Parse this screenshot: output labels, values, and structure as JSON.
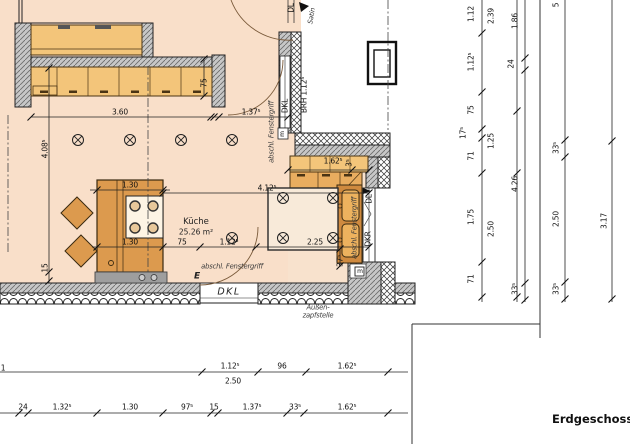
{
  "title": {
    "plan_label": "Erdgeschoss"
  },
  "room": {
    "name": "Küche",
    "area": "25.26 m²"
  },
  "colors": {
    "room": "#f9dfc9",
    "nook": "#f8e2cd",
    "cab": "#f3c57a",
    "mid": "#e9ad5f",
    "island": "#dc9a4e",
    "sinkc": "#cf8a3f",
    "basin": "#edb25e",
    "table": "#f8ead9",
    "wall": "#c7c7c7",
    "plinth": "#9e9e9e",
    "edge": "#3a2a10",
    "dim": "#1a1a1a"
  },
  "labels": [
    {
      "n": "dim-label",
      "t": "3.60",
      "x": 120,
      "y": 112
    },
    {
      "n": "dim-label",
      "t": "1.37⁵",
      "x": 251,
      "y": 112
    },
    {
      "n": "dim-label",
      "t": "4.08⁵",
      "x": 45,
      "y": 149,
      "r": -90
    },
    {
      "n": "dim-label",
      "t": "15",
      "x": 45,
      "y": 268,
      "r": -90
    },
    {
      "n": "dim-label",
      "t": "75",
      "x": 204,
      "y": 83,
      "r": -90
    },
    {
      "n": "dim-label",
      "t": "1.30",
      "x": 130,
      "y": 185
    },
    {
      "n": "dim-label",
      "t": "4.12⁵",
      "x": 267,
      "y": 188
    },
    {
      "n": "dim-label",
      "t": "1.30",
      "x": 130,
      "y": 242
    },
    {
      "n": "dim-label",
      "t": "75",
      "x": 182,
      "y": 242
    },
    {
      "n": "dim-label",
      "t": "1.12⁵",
      "x": 229,
      "y": 242
    },
    {
      "n": "dim-label",
      "t": "2.25",
      "x": 315,
      "y": 242
    },
    {
      "n": "dim-label",
      "t": "1.62⁵",
      "x": 333,
      "y": 161
    },
    {
      "n": "dim-label",
      "t": "3⁵",
      "x": 349,
      "y": 163,
      "r": -90
    },
    {
      "n": "dim-label",
      "t": "37⁵",
      "x": 340,
      "y": 261,
      "r": -90
    },
    {
      "n": "dim-label",
      "t": "1",
      "x": 3,
      "y": 368
    },
    {
      "n": "dim-label",
      "t": "1.12⁵",
      "x": 230,
      "y": 366
    },
    {
      "n": "dim-label",
      "t": "96",
      "x": 282,
      "y": 366
    },
    {
      "n": "dim-label",
      "t": "1.62⁵",
      "x": 347,
      "y": 366
    },
    {
      "n": "dim-label",
      "t": "2.50",
      "x": 233,
      "y": 381
    },
    {
      "n": "dim-label",
      "t": "24",
      "x": 23,
      "y": 407
    },
    {
      "n": "dim-label",
      "t": "1.32⁵",
      "x": 62,
      "y": 407
    },
    {
      "n": "dim-label",
      "t": "1.30",
      "x": 130,
      "y": 407
    },
    {
      "n": "dim-label",
      "t": "97⁵",
      "x": 187,
      "y": 407
    },
    {
      "n": "dim-label",
      "t": "15",
      "x": 214,
      "y": 407
    },
    {
      "n": "dim-label",
      "t": "1.37⁵",
      "x": 252,
      "y": 407
    },
    {
      "n": "dim-label",
      "t": "33⁵",
      "x": 295,
      "y": 407
    },
    {
      "n": "dim-label",
      "t": "1.62⁵",
      "x": 347,
      "y": 407
    },
    {
      "n": "dim-label",
      "t": "1.12",
      "x": 471,
      "y": 14,
      "r": -90
    },
    {
      "n": "dim-label",
      "t": "1.12⁵",
      "x": 471,
      "y": 62,
      "r": -90
    },
    {
      "n": "dim-label",
      "t": "75",
      "x": 471,
      "y": 110,
      "r": -90
    },
    {
      "n": "dim-label",
      "t": "17⁵",
      "x": 463,
      "y": 133,
      "r": -90
    },
    {
      "n": "dim-label",
      "t": "71",
      "x": 471,
      "y": 156,
      "r": -90
    },
    {
      "n": "dim-label",
      "t": "1.75",
      "x": 471,
      "y": 217,
      "r": -90
    },
    {
      "n": "dim-label",
      "t": "71",
      "x": 471,
      "y": 279,
      "r": -90
    },
    {
      "n": "dim-label",
      "t": "2.39",
      "x": 491,
      "y": 16,
      "r": -90
    },
    {
      "n": "dim-label",
      "t": "1.25",
      "x": 491,
      "y": 141,
      "r": -90
    },
    {
      "n": "dim-label",
      "t": "2.50",
      "x": 491,
      "y": 229,
      "r": -90
    },
    {
      "n": "dim-label",
      "t": "1.86",
      "x": 515,
      "y": 21,
      "r": -90
    },
    {
      "n": "dim-label",
      "t": "24",
      "x": 511,
      "y": 64,
      "r": -90
    },
    {
      "n": "dim-label",
      "t": "4.26",
      "x": 515,
      "y": 184,
      "r": -90
    },
    {
      "n": "dim-label",
      "t": "33⁵",
      "x": 515,
      "y": 289,
      "r": -90
    },
    {
      "n": "dim-label",
      "t": "5",
      "x": 556,
      "y": 5,
      "r": -90
    },
    {
      "n": "dim-label",
      "t": "33⁵",
      "x": 556,
      "y": 148,
      "r": -90
    },
    {
      "n": "dim-label",
      "t": "2.50",
      "x": 556,
      "y": 219,
      "r": -90
    },
    {
      "n": "dim-label",
      "t": "33⁵",
      "x": 556,
      "y": 289,
      "r": -90
    },
    {
      "n": "dim-label",
      "t": "3.17",
      "x": 604,
      "y": 221,
      "r": -90
    },
    {
      "n": "window-handle-note",
      "t": "abschl. Fenstergriff",
      "x": 232,
      "y": 267,
      "c": "it"
    },
    {
      "n": "electrical-mark",
      "t": "E",
      "x": 197,
      "y": 277,
      "c": "be"
    },
    {
      "n": "window-handle-note",
      "t": "abschl. Fenstergriff",
      "x": 355,
      "y": 228,
      "r": -90,
      "c": "it"
    },
    {
      "n": "window-handle-note",
      "t": "abschl. Fenstergriff",
      "x": 272,
      "y": 132,
      "r": -90,
      "c": "it"
    },
    {
      "n": "window-label-dkl",
      "t": "DKL",
      "x": 229,
      "y": 292,
      "c": "dkl"
    },
    {
      "n": "window-label-dkl",
      "t": "DKL",
      "x": 285,
      "y": 106,
      "r": -90
    },
    {
      "n": "sill-height-label",
      "t": "BRH 1.12⁵",
      "x": 304,
      "y": 95,
      "r": -90
    },
    {
      "n": "window-label-dl",
      "t": "DL",
      "x": 291,
      "y": 8,
      "r": -90
    },
    {
      "n": "sat-note",
      "t": "Satin",
      "x": 312,
      "y": 16,
      "r": -80,
      "c": "it"
    },
    {
      "n": "window-label-dl",
      "t": "DL",
      "x": 369,
      "y": 199,
      "r": -90
    },
    {
      "n": "window-label-dkr",
      "t": "DKR",
      "x": 368,
      "y": 239,
      "r": -90
    },
    {
      "n": "meter-mark",
      "t": "m",
      "x": 360,
      "y": 272,
      "c": "sm"
    },
    {
      "n": "meter-mark",
      "t": "m",
      "x": 283,
      "y": 134,
      "r": -90,
      "c": "sm"
    },
    {
      "n": "outdoor-tap-note",
      "t": "Außen-",
      "x": 318,
      "y": 308,
      "c": "it"
    },
    {
      "n": "outdoor-tap-note",
      "t": "zapfstelle",
      "x": 318,
      "y": 316,
      "c": "it"
    }
  ]
}
